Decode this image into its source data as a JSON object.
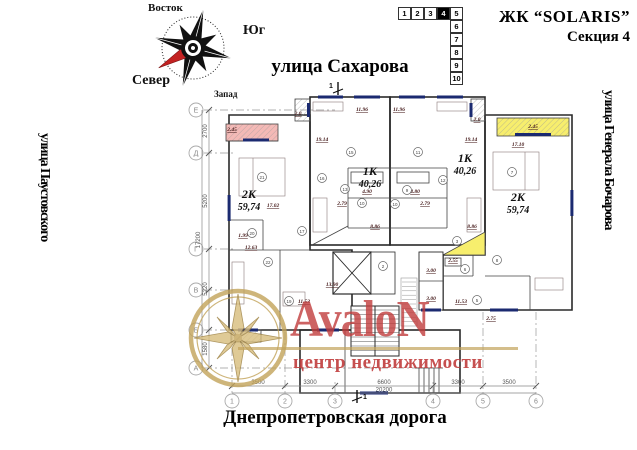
{
  "header": {
    "project": "ЖК “SOLARIS”",
    "section": "Секция 4"
  },
  "compass": {
    "east": "Восток",
    "south": "Юг",
    "north": "Север",
    "west": "Запад"
  },
  "floor_selector": {
    "floors": [
      "1",
      "2",
      "3",
      "4",
      "5",
      "6",
      "7",
      "8",
      "9",
      "10"
    ],
    "active_floor": "4"
  },
  "streets": {
    "top": "улица Сахарова",
    "left": "улица Паустовского",
    "right": "улица Генерала Бочарова",
    "bottom": "Днепропетровская дорога"
  },
  "logo": {
    "name": "AvaloN",
    "subtitle": "центр недвижимости",
    "red": "#c03c3c",
    "gold": "#c2a35a"
  },
  "section_markers": {
    "top": "1",
    "bottom": "1"
  },
  "plan": {
    "colors": {
      "pink": "#f4b9b6",
      "blue": "#aeb9e7",
      "green": "#bdeaa8",
      "yellow": "#f7ee6d",
      "window": "#1b2a70"
    },
    "grid": {
      "rows": [
        "Е",
        "Д",
        "Г",
        "В",
        "Б",
        "А"
      ],
      "cols": [
        "1",
        "2",
        "3",
        "4",
        "5",
        "6"
      ]
    },
    "dims_bottom": {
      "d1": "3500",
      "d2": "3300",
      "d3": "6600",
      "d4": "3300",
      "d5": "3500",
      "total": "20200"
    },
    "dims_left": {
      "d1": "2700",
      "d2": "5200",
      "d3": "5220",
      "d4": "1580",
      "total": "17200"
    },
    "units": {
      "pink": {
        "type": "2К",
        "area": "59,74"
      },
      "blue": {
        "type": "1К",
        "area": "40,26"
      },
      "green": {
        "type": "1К",
        "area": "40,26"
      },
      "yellow": {
        "type": "2К",
        "area": "59,74"
      }
    },
    "labels": {
      "d245_l": "2.45",
      "d20_l": "2.0",
      "d1914_l": "19.14",
      "d1196_l": "11.96",
      "d1196_r": "11.96",
      "d1914_r": "19.14",
      "d20_r": "2.0",
      "d245_r": "2.45",
      "d1710_r": "17.10",
      "d1702_l": "17.02",
      "d199": "1.99",
      "d1263": "12.63",
      "d1153_l": "11.53",
      "d886_l": "8.86",
      "d886_r": "8.86",
      "d490": "4.90",
      "d480": "4.80",
      "d279_l": "2.79",
      "d279_r": "2.79",
      "d255": "2.55",
      "d1153_r": "11.53",
      "d275": "2.75",
      "d300_a": "3.00",
      "d300_b": "3.00",
      "d1390": "13.90"
    },
    "rooms": {
      "r21": "21",
      "r20": "20",
      "r17": "17",
      "r22": "22",
      "r19": "19",
      "r15": "15",
      "r16": "16",
      "r13": "13",
      "r10a": "10",
      "r9": "9",
      "r10b": "10",
      "r11": "11",
      "r12": "12",
      "r7": "7",
      "r8": "8",
      "r3": "3",
      "r6": "6",
      "r5": "5",
      "r2": "2"
    }
  }
}
